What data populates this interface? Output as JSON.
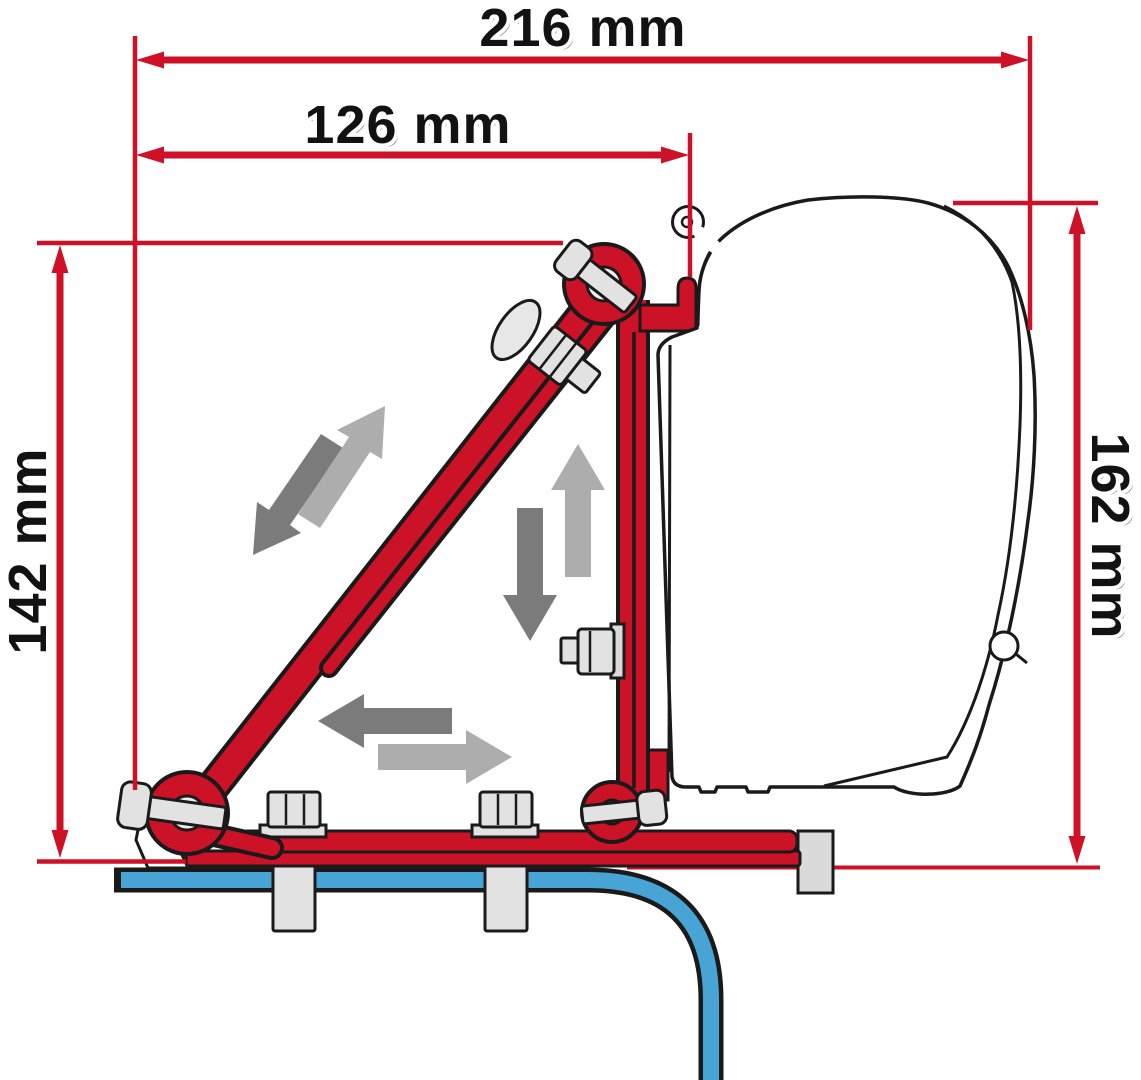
{
  "diagram": {
    "title": "Awning adapter bracket installation diagram (side view)",
    "dimension_labels": {
      "top_width": "216 mm",
      "upper_width": "126 mm",
      "left_height": "142 mm",
      "right_height": "162 mm"
    },
    "colors": {
      "dimension_red": "#ce1126",
      "bracket_red": "#cb1226",
      "roof_blue": "#47a4d5",
      "arrow_light_gray": "#adadad",
      "arrow_dark_gray": "#7b7b7b",
      "outline_black": "#1a1a1a",
      "hardware_gray": "#e2e2e2"
    },
    "adjustment_arrows": [
      "slide-up-right",
      "slide-down-left",
      "slide-up",
      "slide-down",
      "slide-left",
      "slide-right"
    ]
  }
}
